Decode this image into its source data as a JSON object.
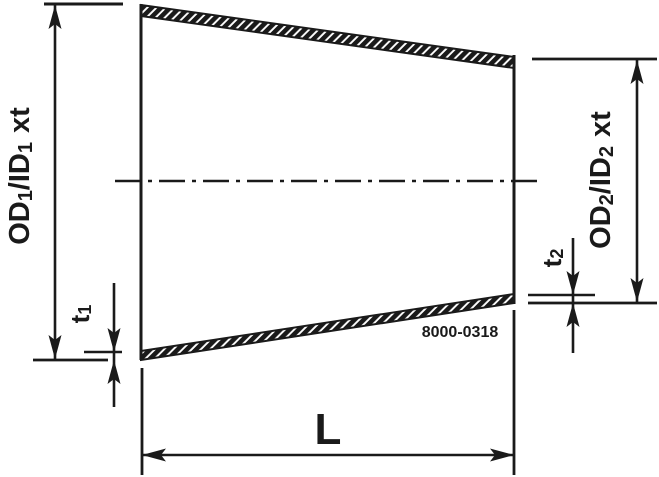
{
  "drawing": {
    "type": "technical-drawing-concentric-reducer",
    "colors": {
      "line": "#1a1a1a",
      "background": "#ffffff"
    },
    "part_number": "8000-0318",
    "labels": {
      "od1": {
        "main": "OD",
        "sub1": "1",
        "mid": "/ID",
        "sub2": "1",
        "tail": "xt"
      },
      "od2": {
        "main": "OD",
        "sub1": "2",
        "mid": "/ID",
        "sub2": "2",
        "tail": "xt"
      },
      "t1": {
        "main": "t",
        "sub": "1"
      },
      "t2": {
        "main": "t",
        "sub": "2"
      },
      "length": "L"
    }
  }
}
